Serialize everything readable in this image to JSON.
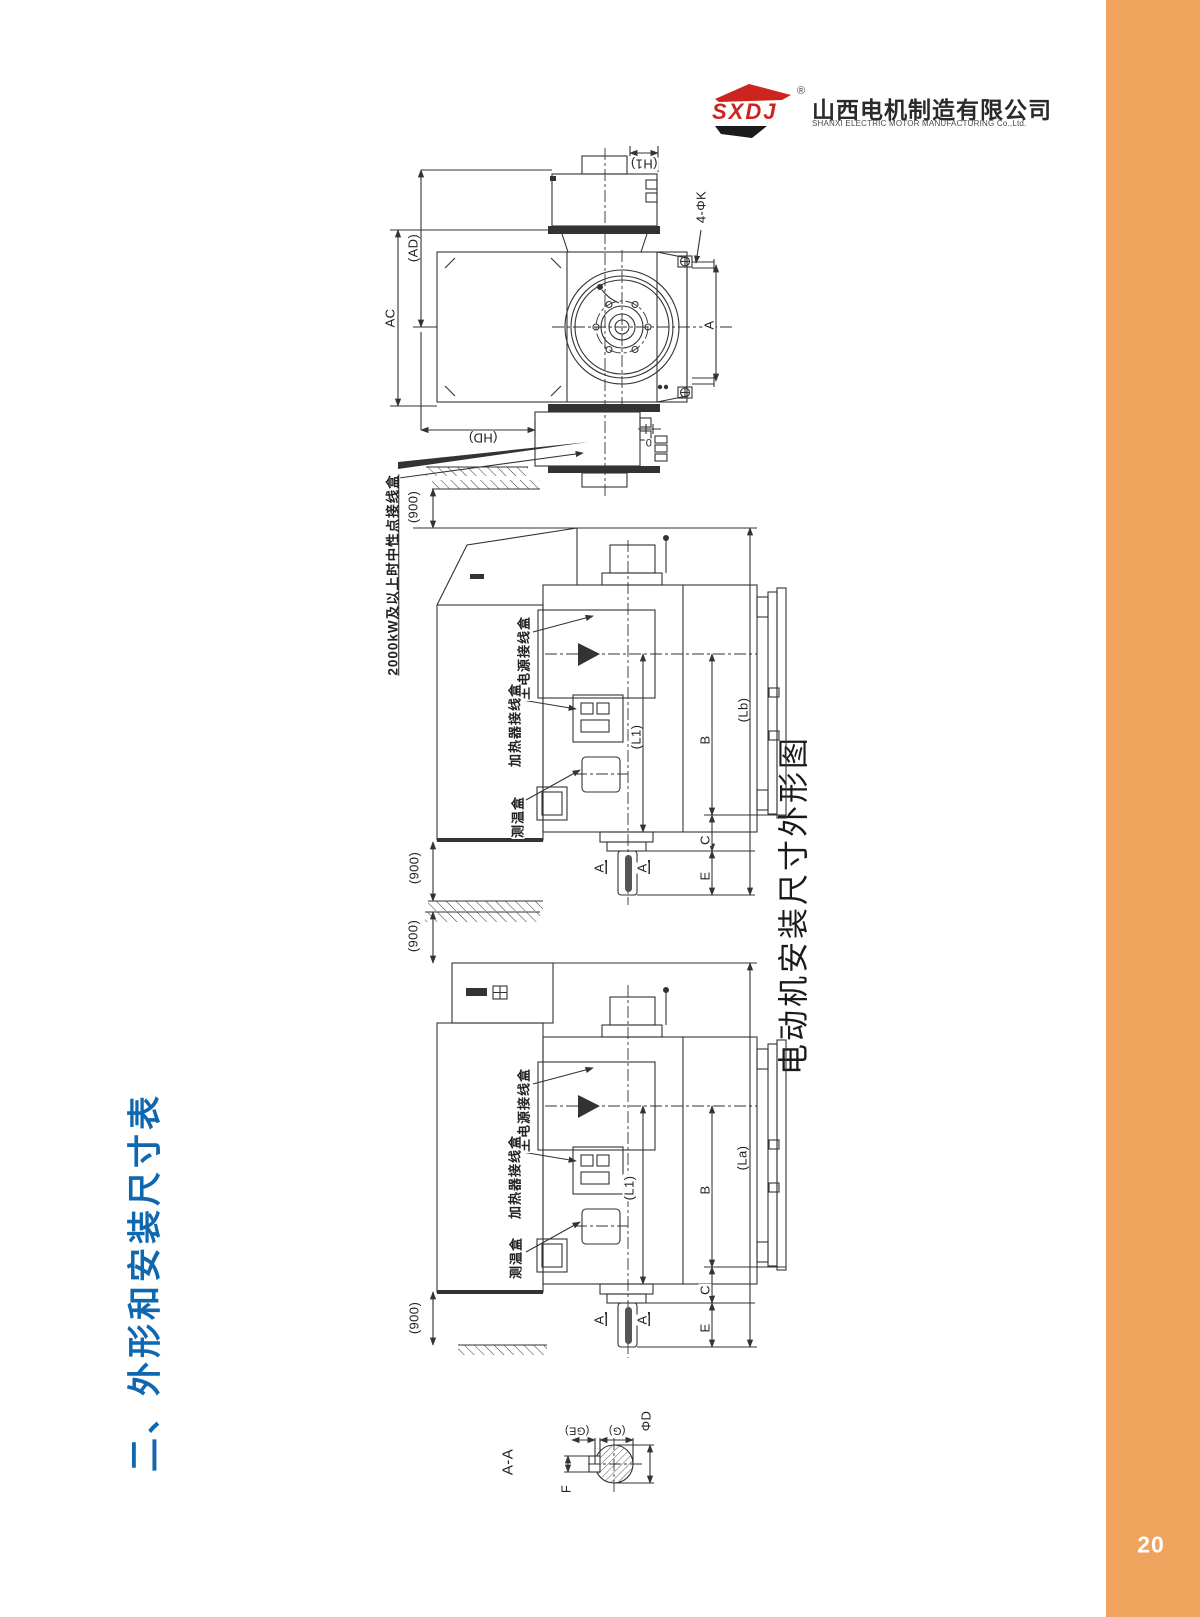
{
  "page": {
    "number": "20",
    "section_title": "二、外形和安装尺寸表",
    "drawing_caption": "电动机安装尺寸外形图"
  },
  "logo": {
    "brand": "SXDJ",
    "registered": "®",
    "company_cn": "山西电机制造有限公司",
    "company_en": "SHANXI ELECTRIC MOTOR MANUFACTURING Co.,Ltd."
  },
  "colors": {
    "accent_orange": "#EFA35D",
    "title_blue": "#0F67AF",
    "logo_red": "#CE2420",
    "line_color": "#333333"
  },
  "end_view": {
    "dim_h1": "(H1)",
    "dim_holes": "4-ΦK",
    "dim_ad": "(AD)",
    "dim_ac": "AC",
    "dim_a": "A",
    "dim_hd": "(HD)",
    "dim_zero": "0",
    "note_neutral_box": "2000kW及以上时中性点接线盒"
  },
  "side_view_middle": {
    "dim_gap_top": "(900)",
    "dim_gap_bottom": "(900)",
    "label_main_box": "主电源接线盒",
    "label_heater_box": "加热器接线盒",
    "label_temp_box": "测温盒",
    "dim_l1": "(L1)",
    "dim_b": "B",
    "dim_c": "C",
    "dim_e": "E",
    "dim_total": "(Lb)",
    "section_mark": "A"
  },
  "side_view_lower": {
    "dim_gap_top": "(900)",
    "dim_gap_bottom": "(900)",
    "label_main_box": "主电源接线盒",
    "label_heater_box": "加热器接线盒",
    "label_temp_box": "测温盒",
    "dim_l1": "(L1)",
    "dim_b": "B",
    "dim_c": "C",
    "dim_e": "E",
    "dim_total": "(La)",
    "section_mark": "A"
  },
  "section_aa": {
    "title": "A-A",
    "dim_ge": "(GE)",
    "dim_g": "(G)",
    "dim_d": "ΦD",
    "dim_f": "F"
  }
}
